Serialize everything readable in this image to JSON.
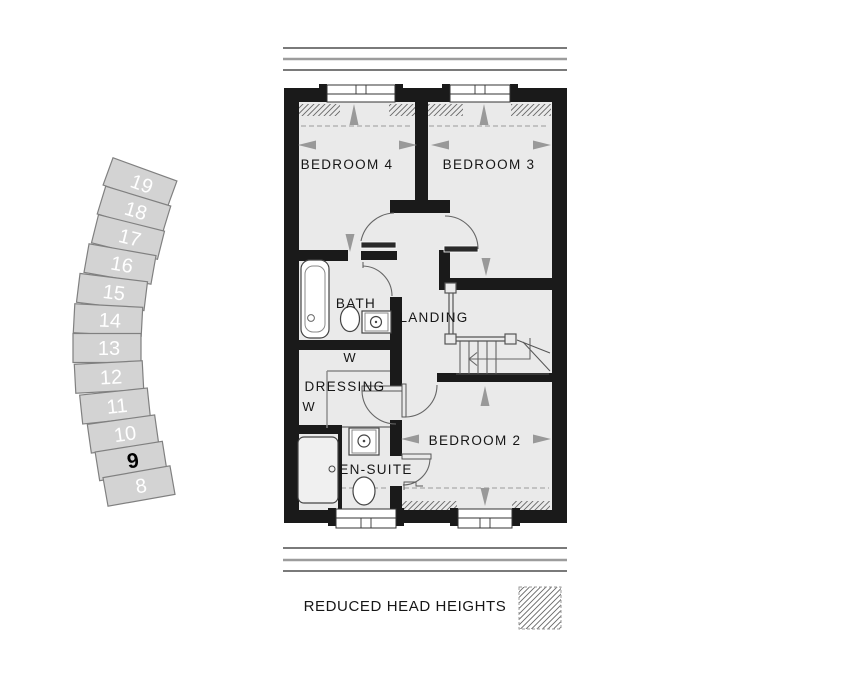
{
  "site_plan": {
    "plots": [
      {
        "number": "19",
        "highlighted": false
      },
      {
        "number": "18",
        "highlighted": false
      },
      {
        "number": "17",
        "highlighted": false
      },
      {
        "number": "16",
        "highlighted": false
      },
      {
        "number": "15",
        "highlighted": false
      },
      {
        "number": "14",
        "highlighted": false
      },
      {
        "number": "13",
        "highlighted": false
      },
      {
        "number": "12",
        "highlighted": false
      },
      {
        "number": "11",
        "highlighted": false
      },
      {
        "number": "10",
        "highlighted": false
      },
      {
        "number": "9",
        "highlighted": true
      },
      {
        "number": "8",
        "highlighted": false
      }
    ]
  },
  "floor_plan": {
    "rooms": {
      "bedroom4": "BEDROOM 4",
      "bedroom3": "BEDROOM 3",
      "bath": "BATH",
      "landing": "LANDING",
      "dressing": "DRESSING",
      "wardrobe_top": "W",
      "wardrobe_left": "W",
      "ensuite": "EN-SUITE",
      "bedroom2": "BEDROOM 2"
    }
  },
  "legend": {
    "reduced_head_heights": "REDUCED HEAD HEIGHTS"
  },
  "colors": {
    "wall": "#1a1a1a",
    "floor": "#eaeaea",
    "plot_fill": "#d3d3d3",
    "plot_stroke": "#808080",
    "plot_number": "#ffffff",
    "plot_number_highlight": "#000000",
    "arrow": "#999999",
    "hatch": "#666666"
  }
}
